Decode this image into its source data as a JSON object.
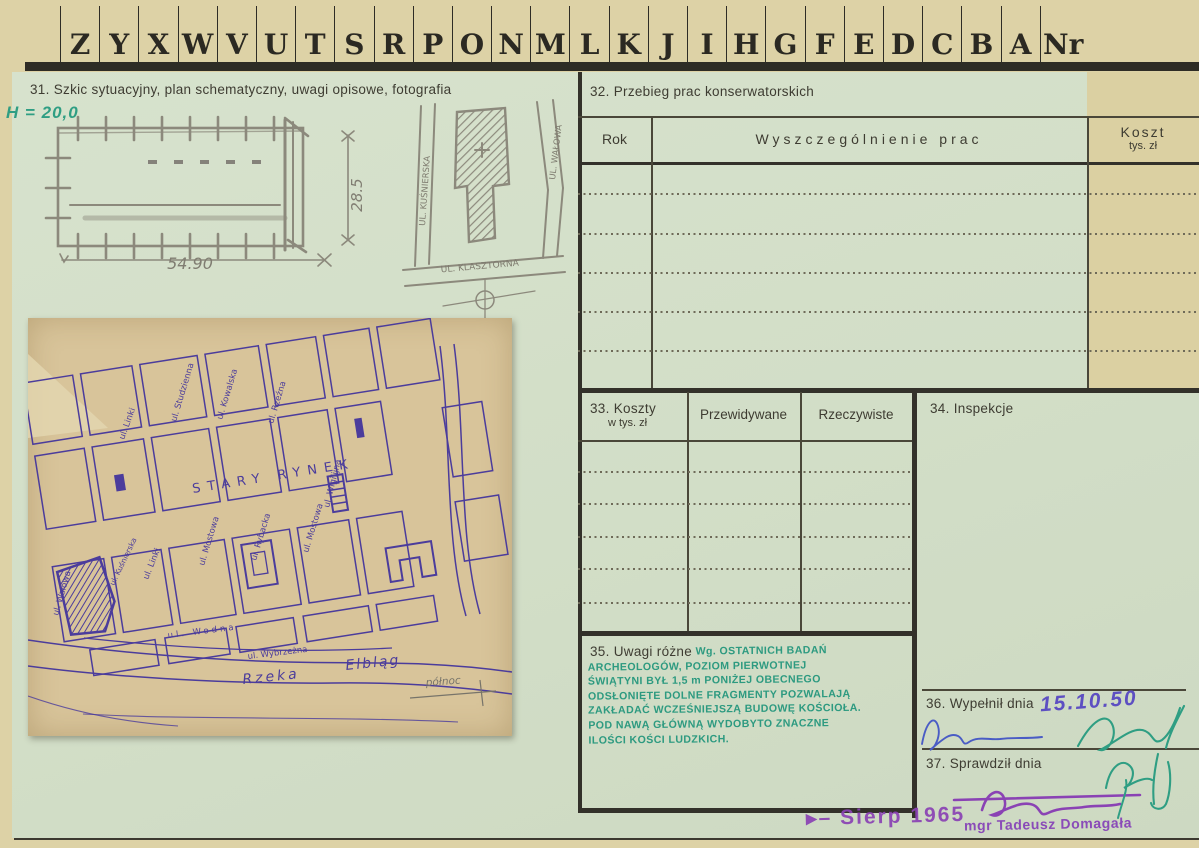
{
  "tabs": {
    "letters": [
      "Z",
      "Y",
      "X",
      "W",
      "V",
      "U",
      "T",
      "S",
      "R",
      "P",
      "O",
      "N",
      "M",
      "L",
      "K",
      "J",
      "I",
      "H",
      "G",
      "F",
      "E",
      "D",
      "C",
      "B",
      "A"
    ],
    "last": "Nr"
  },
  "s31": {
    "title": "31. Szkic sytuacyjny, plan schematyczny, uwagi opisowe, fotografia",
    "height_note": "H = 20,0",
    "dim_width": "54.90",
    "dim_height": "28.5",
    "site": {
      "street_left": "UL. KUŚNIERSKA",
      "street_bottom": "UL. KLASZTORNA",
      "street_right": "UL. WAŁOWA"
    },
    "map": {
      "square": "STARY RYNEK",
      "walowa": "ul. Wałowa",
      "kusnierska": "ul. Kuśnierska",
      "linki": "ul. Linki",
      "linki2": "ul. Linki",
      "studzienna": "ul. Studzienna",
      "kowalska": "ul. Kowalska",
      "rzezna": "ul. Rzeźna",
      "wigilijna": "ul. Wigilijna",
      "mostowa": "ul. Mostowa",
      "rybacka": "ul. Rybacka",
      "mostowa2": "ul. Mostowa",
      "wodna": "ul. Wodna",
      "wybrzezna": "ul. Wybrzeżna",
      "river1": "Rzeka",
      "river2": "Elbląg",
      "north": "północ"
    }
  },
  "s32": {
    "title": "32. Przebieg prac konserwatorskich",
    "col_rok": "Rok",
    "col_prace": "Wyszczególnienie prac",
    "col_koszt": "Koszt",
    "col_koszt_sub": "tys. zł"
  },
  "s33": {
    "title_1": "33. Koszty",
    "title_2": "w tys. zł",
    "col_1": "Przewidywane",
    "col_2": "Rzeczywiste"
  },
  "s34": {
    "title": "34. Inspekcje"
  },
  "s35": {
    "title": "35. Uwagi różne",
    "lines": [
      "Wg. OSTATNICH BADAŃ",
      "ARCHEOLOGÓW, POZIOM PIERWOTNEJ",
      "ŚWIĄTYNI BYŁ 1,5 m PONIŻEJ OBECNEGO",
      "ODSŁONIĘTE DOLNE FRAGMENTY POZWALAJĄ",
      "ZAKŁADAĆ WCZEŚNIEJSZĄ BUDOWĘ KOŚCIOŁA.",
      "POD NAWĄ GŁÓWNĄ WYDOBYTO ZNACZNE",
      "ILOŚCI KOŚCI LUDZKICH."
    ]
  },
  "s36": {
    "title": "36. Wypełnił dnia",
    "date": "15.10.50"
  },
  "s37": {
    "title": "37. Sprawdził dnia",
    "stamp_name": "mgr Tadeusz Domagała"
  },
  "stamp_bottom": {
    "text": "Sierp 1965"
  },
  "colors": {
    "green_ink": "#2f9e83",
    "violet_ink": "#8a42b4",
    "blue_ink": "#4a5cc5",
    "map_ink": "#4b3c9c",
    "pencil": "#8c897c",
    "card_green": "#d3dfc8",
    "paper_tan": "#ddd2a6"
  }
}
